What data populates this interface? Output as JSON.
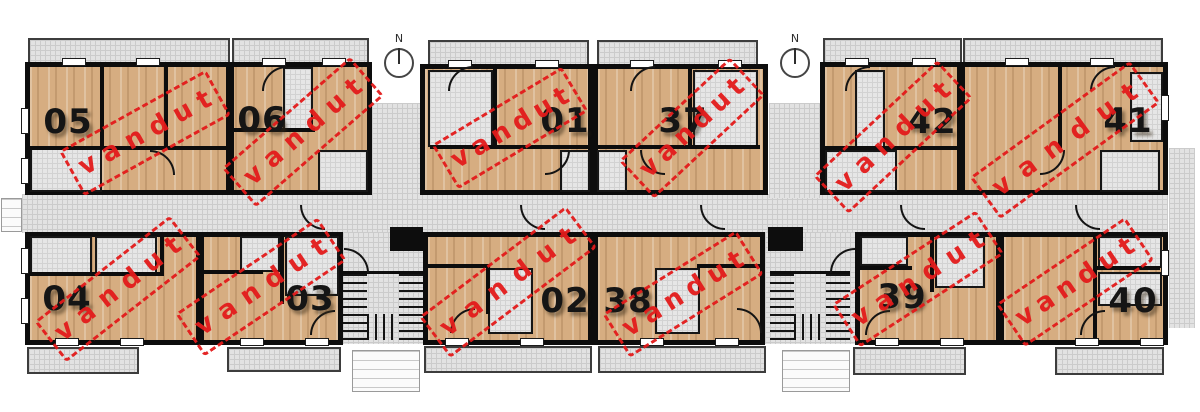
{
  "plan": {
    "stamp_text": "vandut",
    "north_labels": [
      "N",
      "N"
    ],
    "colors": {
      "stamp_red": "#e31b1b",
      "wall_black": "#0d0d0d",
      "wood_floor": "#d6ad81",
      "tile_gray": "#e2e2e2",
      "number_black": "#151515"
    },
    "units": [
      {
        "number": "05",
        "sold": true,
        "num_x": 68,
        "num_y": 122,
        "stamp_x": 145,
        "stamp_y": 133,
        "stamp_angle": -29,
        "stamp_w": 168
      },
      {
        "number": "06",
        "sold": true,
        "num_x": 262,
        "num_y": 120,
        "stamp_x": 303,
        "stamp_y": 132,
        "stamp_angle": -41,
        "stamp_w": 170
      },
      {
        "number": "01",
        "sold": true,
        "num_x": 565,
        "num_y": 121,
        "stamp_x": 510,
        "stamp_y": 128,
        "stamp_angle": -31,
        "stamp_w": 152
      },
      {
        "number": "37",
        "sold": true,
        "num_x": 683,
        "num_y": 121,
        "stamp_x": 692,
        "stamp_y": 128,
        "stamp_angle": -43,
        "stamp_w": 152
      },
      {
        "number": "42",
        "sold": true,
        "num_x": 932,
        "num_y": 122,
        "stamp_x": 893,
        "stamp_y": 137,
        "stamp_angle": -43,
        "stamp_w": 170
      },
      {
        "number": "41",
        "sold": true,
        "num_x": 1128,
        "num_y": 121,
        "stamp_x": 1065,
        "stamp_y": 140,
        "stamp_angle": -36,
        "stamp_w": 198
      },
      {
        "number": "04",
        "sold": true,
        "num_x": 67,
        "num_y": 299,
        "stamp_x": 118,
        "stamp_y": 289,
        "stamp_angle": -38,
        "stamp_w": 172
      },
      {
        "number": "03",
        "sold": true,
        "num_x": 310,
        "num_y": 299,
        "stamp_x": 261,
        "stamp_y": 287,
        "stamp_angle": -34,
        "stamp_w": 172
      },
      {
        "number": "02",
        "sold": true,
        "num_x": 565,
        "num_y": 301,
        "stamp_x": 508,
        "stamp_y": 282,
        "stamp_angle": -37,
        "stamp_w": 184
      },
      {
        "number": "38",
        "sold": true,
        "num_x": 628,
        "num_y": 301,
        "stamp_x": 683,
        "stamp_y": 294,
        "stamp_angle": -32,
        "stamp_w": 158
      },
      {
        "number": "39",
        "sold": true,
        "num_x": 902,
        "num_y": 297,
        "stamp_x": 918,
        "stamp_y": 279,
        "stamp_angle": -33,
        "stamp_w": 172
      },
      {
        "number": "40",
        "sold": true,
        "num_x": 1133,
        "num_y": 301,
        "stamp_x": 1075,
        "stamp_y": 282,
        "stamp_angle": -34,
        "stamp_w": 156
      }
    ]
  }
}
